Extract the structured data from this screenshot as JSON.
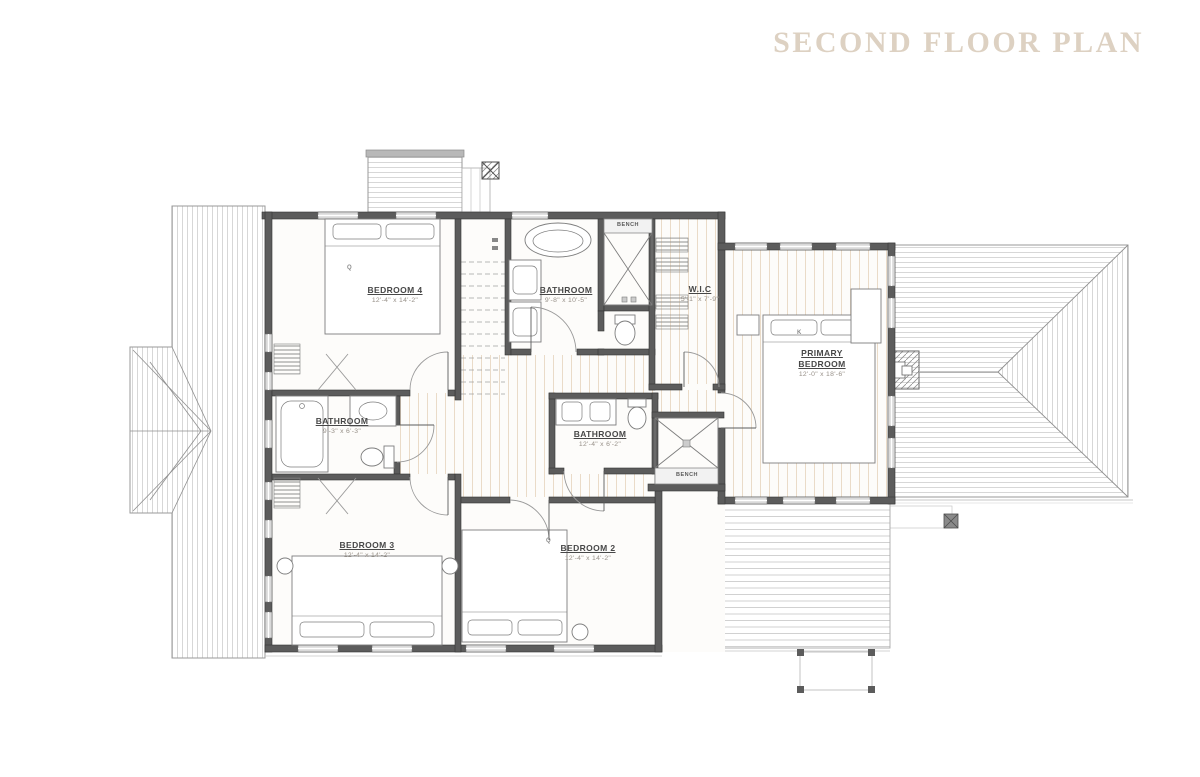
{
  "title": "SECOND FLOOR PLAN",
  "colors": {
    "accent": "#DDD1C2",
    "wall": "#5C5C5C",
    "roof_line": "#C2C2C2",
    "floor_tint": "#EADBC8"
  },
  "plan": {
    "rooms": [
      {
        "id": "bedroom-4",
        "name": "BEDROOM 4",
        "dims": "12'-4\" x 14'-2\""
      },
      {
        "id": "bathroom-top",
        "name": "BATHROOM",
        "dims": "9'-8\" x 10'-5\""
      },
      {
        "id": "wic",
        "name": "W.I.C",
        "dims": "5'-1\" x 7'-9\""
      },
      {
        "id": "primary-bedroom",
        "name": "PRIMARY BEDROOM",
        "dims": "12'-0\" x 18'-6\""
      },
      {
        "id": "bathroom-left",
        "name": "BATHROOM",
        "dims": "9'-3\" x 6'-3\""
      },
      {
        "id": "bathroom-center",
        "name": "BATHROOM",
        "dims": "12'-4\" x 6'-2\""
      },
      {
        "id": "bedroom-3",
        "name": "BEDROOM 3",
        "dims": "12'-4\" x 14'-2\""
      },
      {
        "id": "bedroom-2",
        "name": "BEDROOM 2",
        "dims": "12'-4\" x 14'-2\""
      }
    ],
    "annotations": {
      "bench_top": "BENCH",
      "bench_shower": "BENCH",
      "bed_q4": "Q",
      "bed_k": "K",
      "bed_q2": "Q"
    }
  }
}
